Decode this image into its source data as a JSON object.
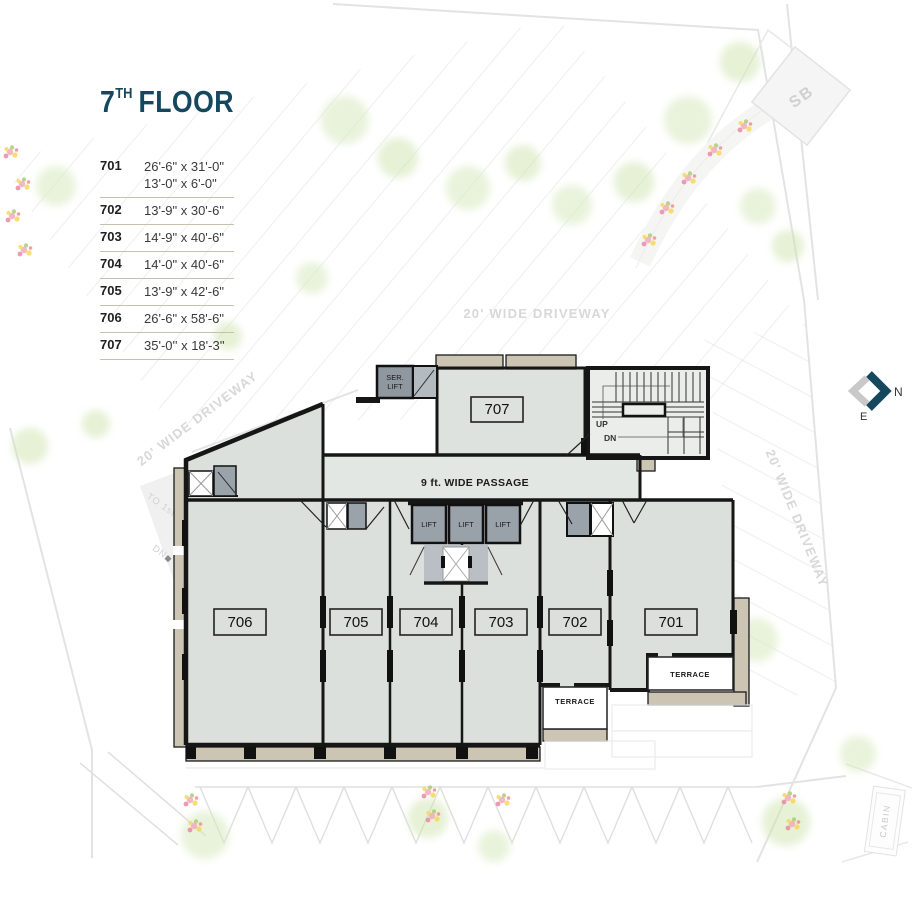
{
  "colors": {
    "accent_navy": "#15485e",
    "room_fill": "#dbe0dd",
    "corridor_fill": "#e3e7e4",
    "stair_fill": "#eaede9",
    "lift_gray": "#99a1a9",
    "wall_black": "#161616",
    "wall_tan": "#cdc5b4",
    "legend_rule_tan": "#c8bfae",
    "faint_site_gray": "#e3e3e3",
    "driveway_text_gray": "#d8d8d8"
  },
  "title": {
    "num": "7",
    "sup": "TH",
    "word": "FLOOR"
  },
  "legend": [
    {
      "unit": "701",
      "dim1": "26'-6\" x 31'-0\"",
      "dim2": "13'-0\" x 6'-0\""
    },
    {
      "unit": "702",
      "dim1": "13'-9\" x 30'-6\""
    },
    {
      "unit": "703",
      "dim1": "14'-9\" x 40'-6\""
    },
    {
      "unit": "704",
      "dim1": "14'-0\" x 40'-6\""
    },
    {
      "unit": "705",
      "dim1": "13'-9\" x 42'-6\""
    },
    {
      "unit": "706",
      "dim1": "26'-6\" x 58'-6\""
    },
    {
      "unit": "707",
      "dim1": "35'-0'' x 18'-3''"
    }
  ],
  "plan": {
    "passage": "9 ft. WIDE PASSAGE",
    "ser1": "SER.",
    "ser2": "LIFT",
    "lift": "LIFT",
    "up": "UP",
    "dn": "DN",
    "terrace": "TERRACE",
    "units": {
      "u701": "701",
      "u702": "702",
      "u703": "703",
      "u704": "704",
      "u705": "705",
      "u706": "706",
      "u707": "707"
    }
  },
  "site": {
    "driveway": "20' WIDE DRIVEWAY",
    "ramp": "TO 1st BASEMENT",
    "ramp_dn": "DN",
    "sb": "SB",
    "cabin": "CABIN",
    "compass_n": "N",
    "compass_e": "E"
  }
}
